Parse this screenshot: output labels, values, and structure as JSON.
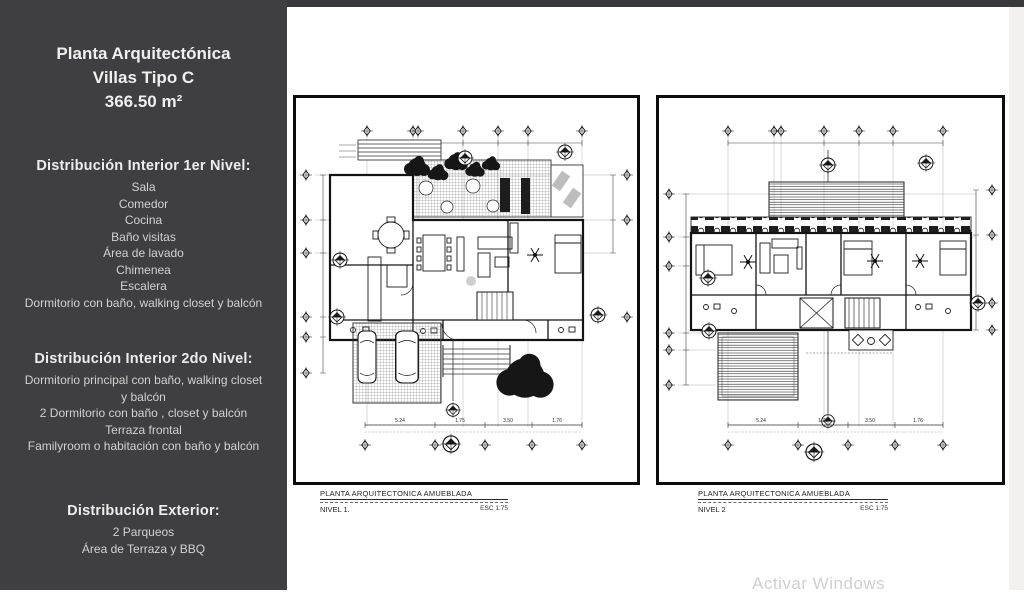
{
  "colors": {
    "sidebar_bg": "#3f3e40",
    "content_bg": "#ffffff",
    "plan_line": "#111111",
    "watermark": "#a9a9a9"
  },
  "sidebar": {
    "title_lines": [
      "Planta Arquitectónica",
      "Villas Tipo C",
      "366.50 m²"
    ],
    "sections": [
      {
        "heading": "Distribución Interior 1er Nivel:",
        "items": [
          "Sala",
          "Comedor",
          "Cocina",
          "Baño visitas",
          "Área de lavado",
          "Chimenea",
          "Escalera",
          "Dormitorio con baño, walking closet y balcón"
        ]
      },
      {
        "heading": "Distribución Interior 2do Nivel:",
        "items": [
          "Dormitorio principal con baño, walking closet y balcón",
          "2 Dormitorio con baño , closet y balcón",
          "Terraza frontal",
          "Familyroom o habitación con baño y balcón"
        ]
      },
      {
        "heading": "Distribución Exterior:",
        "items": [
          "2 Parqueos",
          "Área de Terraza y BBQ"
        ]
      }
    ]
  },
  "plans": [
    {
      "caption": "PLANTA ARQUITECTONICA AMUEBLADA",
      "level": "NIVEL 1.",
      "scale": "ESC 1:75",
      "dims": [
        "5.24",
        "1.75",
        "3.50",
        "1.76"
      ]
    },
    {
      "caption": "PLANTA ARQUITECTONICA AMUEBLADA",
      "level": "NIVEL 2",
      "scale": "ESC 1:75",
      "dims": [
        "5.24",
        "1.75",
        "3.50",
        "1.76"
      ]
    }
  ],
  "watermark": "Activar Windows"
}
